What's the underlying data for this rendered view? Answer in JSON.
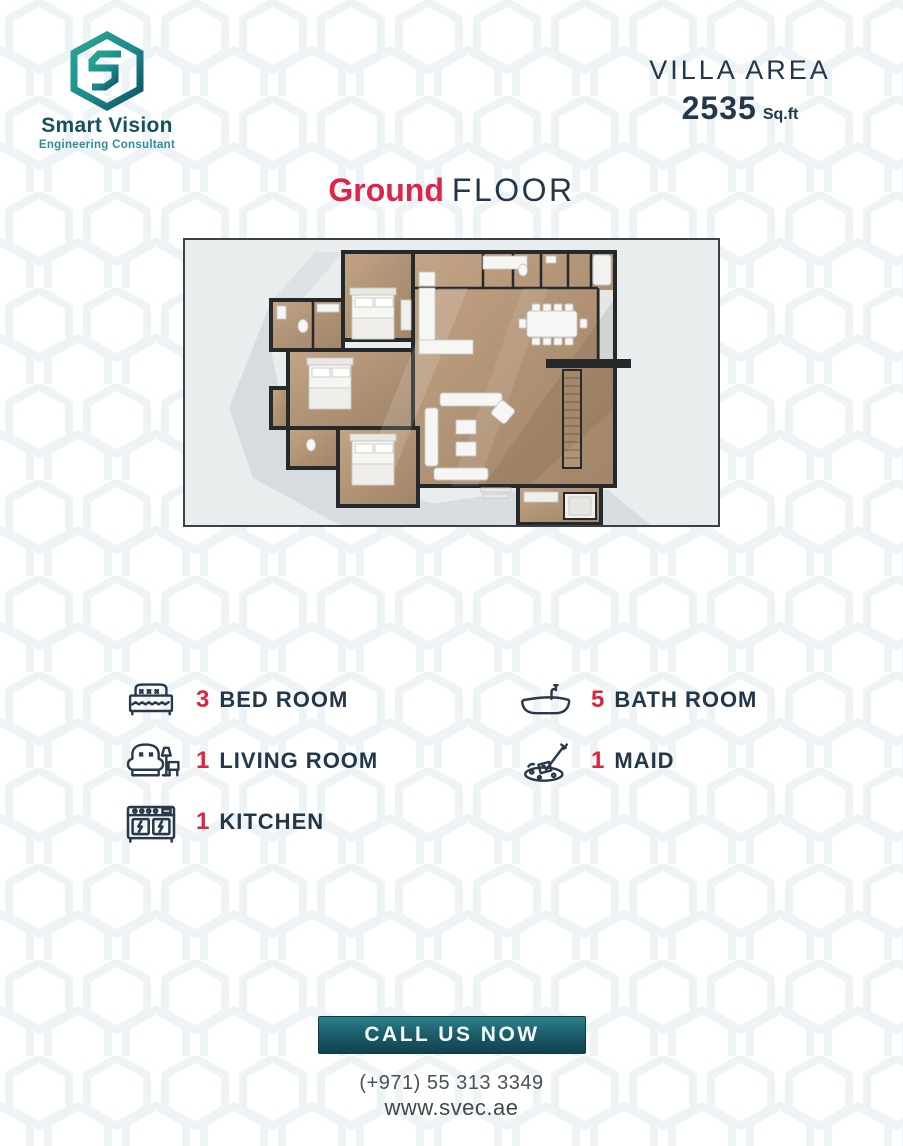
{
  "brand": {
    "name": "Smart Vision",
    "tagline": "Engineering Consultant",
    "logo_icon": "hexagon-s-logo",
    "color_teal": "#1f8d8d",
    "color_teal_dark": "#0d4f5e"
  },
  "header": {
    "area_label": "VILLA AREA",
    "area_value": "2535",
    "area_unit": "Sq.ft"
  },
  "title": {
    "highlight": "Ground",
    "rest": "FLOOR"
  },
  "floor_plan": {
    "description": "3D top-down render of ground floor: three bedrooms and bathrooms on the left wing, open plan kitchen, dining and living area on the right, stairs at right edge, utility rooms along the top and bottom-right"
  },
  "features": {
    "left": [
      {
        "count": "3",
        "label": "BED ROOM",
        "icon": "bed-icon"
      },
      {
        "count": "1",
        "label": "LIVING ROOM",
        "icon": "armchair-icon"
      },
      {
        "count": "1",
        "label": "KITCHEN",
        "icon": "stove-icon"
      }
    ],
    "right": [
      {
        "count": "5",
        "label": "BATH ROOM",
        "icon": "bathtub-icon"
      },
      {
        "count": "1",
        "label": "MAID",
        "icon": "cleaning-icon"
      }
    ]
  },
  "footer": {
    "cta_label": "CALL US NOW",
    "phone": "(+971) 55 313 3349",
    "website": "www.svec.ae"
  },
  "colors": {
    "accent_red": "#e02449",
    "navy_text": "#22384a",
    "button_teal_top": "#2e818d",
    "button_teal_bottom": "#11414d"
  }
}
